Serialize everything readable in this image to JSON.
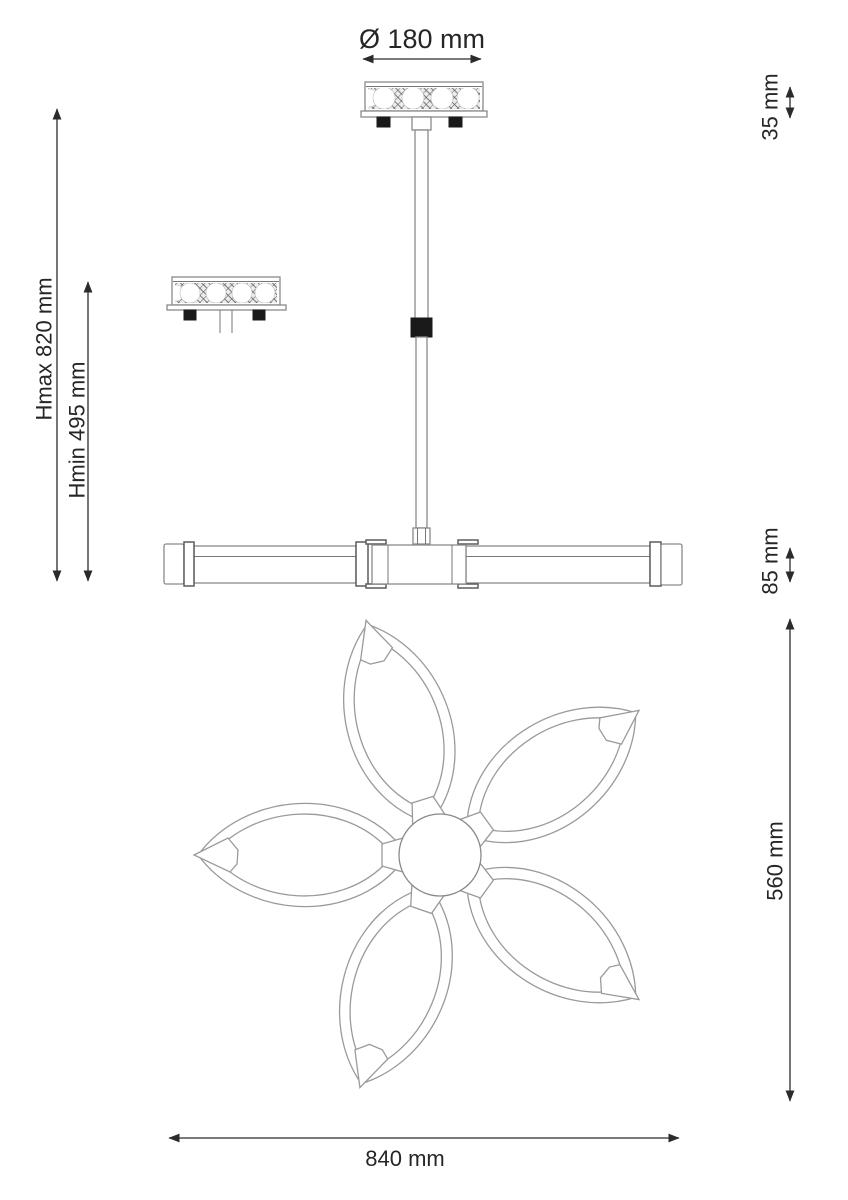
{
  "page": {
    "background": "#ffffff",
    "type": "lamp-dimension-drawing"
  },
  "colors": {
    "dimension_line": "#2b2b2b",
    "text": "#262626",
    "outline": "#8a8a8a",
    "outline_dark": "#5c5c5c",
    "hardware_black": "#1a1a1a",
    "hatch_line": "#5a5a5a",
    "white": "#ffffff"
  },
  "labels": {
    "canopy_diameter": "Ø 180 mm",
    "canopy_height": "35 mm",
    "height_max": "Hmax 820 mm",
    "height_min": "Hmin 495 mm",
    "body_height": "85 mm",
    "flower_depth": "560 mm",
    "flower_width": "840 mm"
  }
}
